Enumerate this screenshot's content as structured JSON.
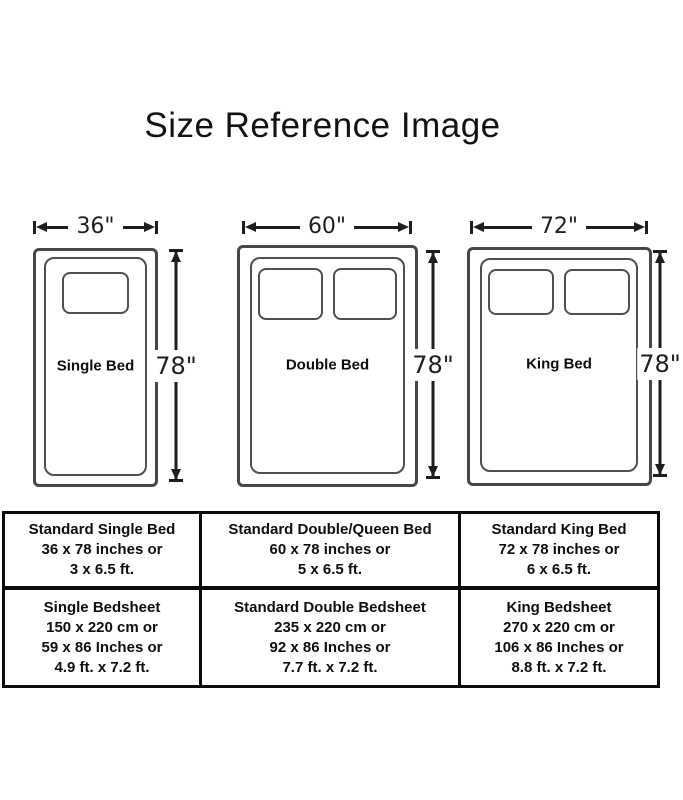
{
  "title": "Size Reference Image",
  "beds": [
    {
      "name": "Single Bed",
      "width_label": "36\"",
      "height_label": "78\""
    },
    {
      "name": "Double Bed",
      "width_label": "60\"",
      "height_label": "78\""
    },
    {
      "name": "King Bed",
      "width_label": "72\"",
      "height_label": "78\""
    }
  ],
  "spec_table": {
    "bed_row": [
      {
        "lines": [
          "Standard Single Bed",
          "36 x 78 inches or",
          "3 x 6.5 ft."
        ]
      },
      {
        "lines": [
          "Standard Double/Queen Bed",
          "60 x 78 inches or",
          "5 x 6.5 ft."
        ]
      },
      {
        "lines": [
          "Standard King Bed",
          "72 x 78 inches or",
          "6 x 6.5 ft."
        ]
      }
    ],
    "sheet_row": [
      {
        "lines": [
          "Single Bedsheet",
          "150 x 220 cm or",
          "59 x 86 Inches or",
          "4.9 ft. x 7.2 ft."
        ]
      },
      {
        "lines": [
          "Standard Double Bedsheet",
          "235 x 220 cm or",
          "92 x 86 Inches or",
          "7.7 ft. x 7.2 ft."
        ]
      },
      {
        "lines": [
          "King Bedsheet",
          "270 x 220 cm or",
          "106 x 86 Inches or",
          "8.8 ft. x 7.2 ft."
        ]
      }
    ]
  },
  "colors": {
    "outline": "#474747",
    "arrow": "#1e1e1e",
    "table_border": "#0b0b0b",
    "text": "#0e0e0e"
  }
}
